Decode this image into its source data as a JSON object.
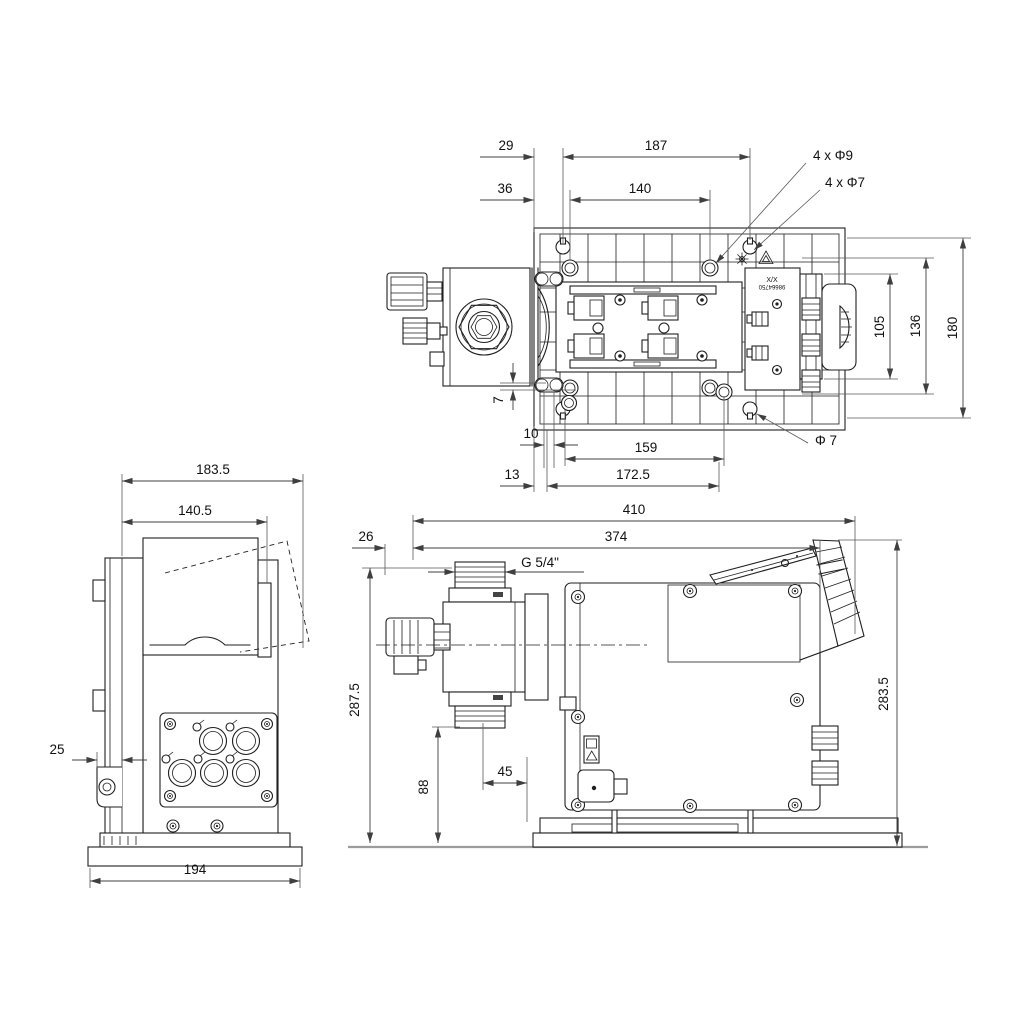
{
  "drawing": {
    "type": "dimensional-drawing",
    "views": [
      "top-view",
      "front-view",
      "side-view"
    ],
    "colors": {
      "line": "#1f1f1f",
      "dimension": "#3f3f3f",
      "ground": "#9c9c9c",
      "background": "#ffffff"
    }
  },
  "dims": {
    "top": {
      "w29": "29",
      "w187": "187",
      "w36": "36",
      "w140": "140",
      "holes_big": "4 x Φ9",
      "holes_small": "4 x Φ7",
      "h105": "105",
      "h136": "136",
      "h180": "180",
      "v7": "7",
      "w10": "10",
      "w159": "159",
      "dia7": "Φ 7",
      "w13": "13",
      "w172_5": "172.5"
    },
    "front": {
      "w183_5": "183.5",
      "w140_5": "140.5",
      "w25": "25",
      "w194": "194"
    },
    "side": {
      "w410": "410",
      "w374": "374",
      "w26": "26",
      "thread": "G 5/4\"",
      "h287_5": "287.5",
      "h88": "88",
      "w45": "45",
      "h283_5": "283.5"
    },
    "labels": {
      "type_line1": "X/X",
      "type_line2": "98664750"
    }
  }
}
